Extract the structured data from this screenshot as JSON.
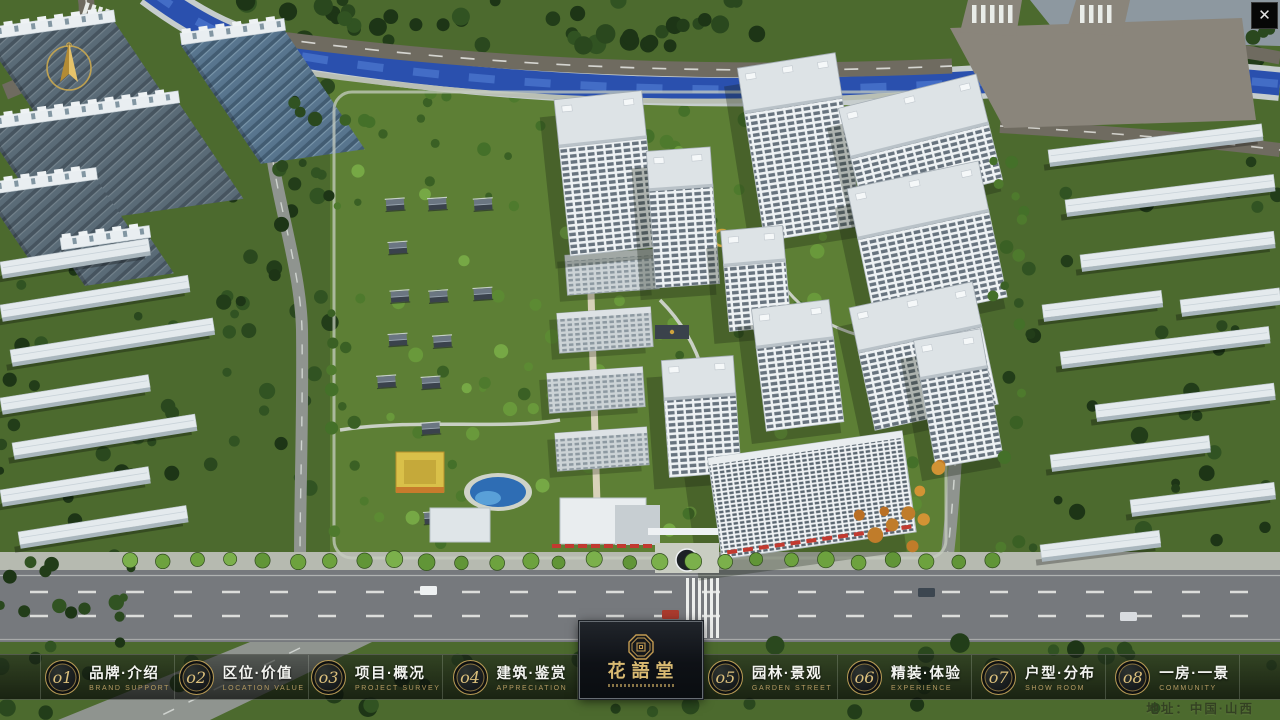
{
  "app": {
    "close_icon": "✕"
  },
  "navbar": {
    "items": [
      {
        "num": "o1",
        "cn": "品牌·介绍",
        "en": "BRAND SUPPORT"
      },
      {
        "num": "o2",
        "cn": "区位·价值",
        "en": "LOCATION VALUE"
      },
      {
        "num": "o3",
        "cn": "项目·概况",
        "en": "PROJECT SURVEY"
      },
      {
        "num": "o4",
        "cn": "建筑·鉴赏",
        "en": "APPRECIATION"
      },
      {
        "num": "o5",
        "cn": "园林·景观",
        "en": "GARDEN STREET"
      },
      {
        "num": "o6",
        "cn": "精装·体验",
        "en": "EXPERIENCE"
      },
      {
        "num": "o7",
        "cn": "户型·分布",
        "en": "SHOW ROOM"
      },
      {
        "num": "o8",
        "cn": "一房·一景",
        "en": "COMMUNITY"
      }
    ],
    "logo": {
      "title": "花語堂",
      "seal_icon": "octagonal-seal"
    }
  },
  "footer": {
    "address": "地址：中国·山西"
  },
  "colors": {
    "gold": "#c9a25a",
    "water": "#2a50ae",
    "road": "#6f6b60",
    "lawn": "#5d7f35",
    "tree_dark": "#2a481e",
    "building_white": "#e7ecef",
    "awning_red": "#c23a30",
    "nav_bg": "rgba(10,14,10,0.6)"
  }
}
